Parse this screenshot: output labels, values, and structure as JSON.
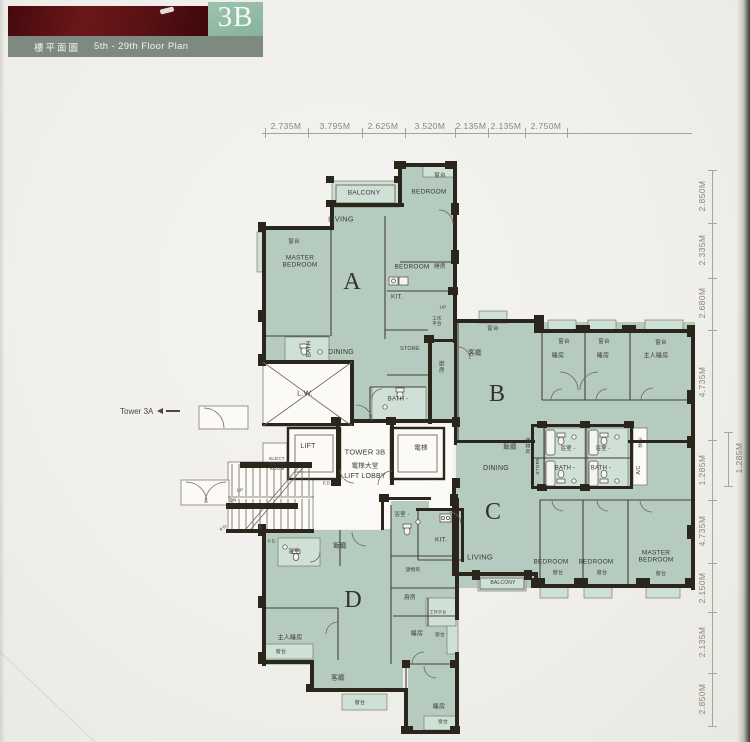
{
  "header": {
    "unit": "3B",
    "title_zh": "樓平面圖",
    "title_en": "5th - 29th Floor Plan"
  },
  "tower_ref": {
    "label": "Tower 3A"
  },
  "plan": {
    "labels": [
      {
        "t": "BALCONY",
        "x": 364,
        "y": 193,
        "s": 6.5
      },
      {
        "t": "窗台",
        "x": 440,
        "y": 176,
        "s": 5.5
      },
      {
        "t": "BEDROOM",
        "x": 429,
        "y": 192,
        "s": 6.5
      },
      {
        "t": "LIVING",
        "x": 341,
        "y": 220,
        "s": 7.5
      },
      {
        "t": "窗台",
        "x": 294,
        "y": 242,
        "s": 5.5
      },
      {
        "t": "MASTER\nBEDROOM",
        "x": 300,
        "y": 262,
        "s": 6.5
      },
      {
        "t": "A",
        "x": 352,
        "y": 283,
        "s": 24
      },
      {
        "t": "BEDROOM",
        "x": 412,
        "y": 267,
        "s": 6.5
      },
      {
        "t": "睡房",
        "x": 440,
        "y": 267,
        "s": 5.5
      },
      {
        "t": "KIT.",
        "x": 397,
        "y": 297,
        "s": 6.5
      },
      {
        "t": "UP",
        "x": 443,
        "y": 307,
        "s": 4.5
      },
      {
        "t": "工作\n平台",
        "x": 437,
        "y": 321,
        "s": 4.5
      },
      {
        "t": "BATH",
        "x": 310,
        "y": 349,
        "s": 6,
        "r": -90
      },
      {
        "t": "DINING",
        "x": 341,
        "y": 353,
        "s": 7
      },
      {
        "t": "STORE",
        "x": 410,
        "y": 349,
        "s": 5.5
      },
      {
        "t": "廚房",
        "x": 440,
        "y": 367,
        "s": 5.5,
        "v": 1
      },
      {
        "t": "BATH -",
        "x": 398,
        "y": 400,
        "s": 6
      },
      {
        "t": "L.W.",
        "x": 305,
        "y": 394,
        "s": 7.5
      },
      {
        "t": "窗台",
        "x": 493,
        "y": 329,
        "s": 5.5
      },
      {
        "t": "客廳",
        "x": 475,
        "y": 353,
        "s": 6.5
      },
      {
        "t": "B",
        "x": 497,
        "y": 395,
        "s": 24
      },
      {
        "t": "窗台",
        "x": 564,
        "y": 342,
        "s": 5.5
      },
      {
        "t": "窗台",
        "x": 604,
        "y": 342,
        "s": 5.5
      },
      {
        "t": "窗台",
        "x": 661,
        "y": 343,
        "s": 5.5
      },
      {
        "t": "睡房",
        "x": 558,
        "y": 357,
        "s": 6
      },
      {
        "t": "睡房",
        "x": 603,
        "y": 357,
        "s": 6
      },
      {
        "t": "主人睡房",
        "x": 656,
        "y": 357,
        "s": 6
      },
      {
        "t": "飯廳",
        "x": 510,
        "y": 447,
        "s": 6.5
      },
      {
        "t": "儲物房",
        "x": 526,
        "y": 446,
        "s": 4.8,
        "v": 1
      },
      {
        "t": "STORE",
        "x": 539,
        "y": 466,
        "s": 4.8,
        "r": -90
      },
      {
        "t": "浴室 -",
        "x": 568,
        "y": 449,
        "s": 5.5
      },
      {
        "t": "浴室 -",
        "x": 603,
        "y": 449,
        "s": 5.5
      },
      {
        "t": "冷氣",
        "x": 640,
        "y": 443,
        "s": 4.5,
        "v": 1
      },
      {
        "t": "A/C",
        "x": 640,
        "y": 470,
        "s": 5,
        "r": -90
      },
      {
        "t": "DINING",
        "x": 496,
        "y": 469,
        "s": 7
      },
      {
        "t": "BATH -",
        "x": 565,
        "y": 469,
        "s": 6
      },
      {
        "t": "BATH -",
        "x": 601,
        "y": 469,
        "s": 6
      },
      {
        "t": "C",
        "x": 493,
        "y": 513,
        "s": 24
      },
      {
        "t": "LIVING",
        "x": 480,
        "y": 558,
        "s": 7.5
      },
      {
        "t": "KIT.",
        "x": 441,
        "y": 540,
        "s": 6.5
      },
      {
        "t": "BEDROOM",
        "x": 551,
        "y": 562,
        "s": 6.5
      },
      {
        "t": "BEDROOM",
        "x": 596,
        "y": 562,
        "s": 6.5
      },
      {
        "t": "MASTER\nBEDROOM",
        "x": 656,
        "y": 557,
        "s": 6.5
      },
      {
        "t": "窗台",
        "x": 558,
        "y": 574,
        "s": 5
      },
      {
        "t": "窗台",
        "x": 602,
        "y": 574,
        "s": 5
      },
      {
        "t": "窗台",
        "x": 661,
        "y": 575,
        "s": 5
      },
      {
        "t": "BALCONY",
        "x": 503,
        "y": 584,
        "s": 5
      },
      {
        "t": "P.D.",
        "x": 327,
        "y": 484,
        "s": 4.2
      },
      {
        "t": "P.D.",
        "x": 224,
        "y": 528,
        "s": 4.2,
        "r": -40
      },
      {
        "t": "P.D.",
        "x": 272,
        "y": 541,
        "s": 4.5
      },
      {
        "t": "浴室",
        "x": 294,
        "y": 552,
        "s": 5.5
      },
      {
        "t": "飯廳",
        "x": 340,
        "y": 546,
        "s": 6.5
      },
      {
        "t": "浴室 -",
        "x": 402,
        "y": 515,
        "s": 5.5
      },
      {
        "t": "D",
        "x": 353,
        "y": 601,
        "s": 24
      },
      {
        "t": "儲物房",
        "x": 413,
        "y": 571,
        "s": 4.8
      },
      {
        "t": "廚房",
        "x": 410,
        "y": 598,
        "s": 5.5
      },
      {
        "t": "工作平台",
        "x": 438,
        "y": 613,
        "s": 4
      },
      {
        "t": "睡房",
        "x": 417,
        "y": 635,
        "s": 6
      },
      {
        "t": "窗台",
        "x": 440,
        "y": 636,
        "s": 4.8
      },
      {
        "t": "主人睡房",
        "x": 290,
        "y": 639,
        "s": 6
      },
      {
        "t": "窗台",
        "x": 281,
        "y": 653,
        "s": 5
      },
      {
        "t": "客廳",
        "x": 338,
        "y": 678,
        "s": 6.5
      },
      {
        "t": "窗台",
        "x": 360,
        "y": 704,
        "s": 5
      },
      {
        "t": "睡房",
        "x": 439,
        "y": 708,
        "s": 6
      },
      {
        "t": "窗台",
        "x": 443,
        "y": 723,
        "s": 4.8
      },
      {
        "t": "UP",
        "x": 240,
        "y": 490,
        "s": 4.5
      },
      {
        "t": "DN",
        "x": 233,
        "y": 500,
        "s": 4.5
      },
      {
        "t": "LIFT",
        "x": 308,
        "y": 447,
        "s": 7
      },
      {
        "t": "電梯",
        "x": 421,
        "y": 448,
        "s": 6.5
      },
      {
        "t": "TOWER 3B",
        "x": 365,
        "y": 453,
        "s": 7.5
      },
      {
        "t": "電梯大堂",
        "x": 365,
        "y": 466,
        "s": 6.5
      },
      {
        "t": "LIFT LOBBY",
        "x": 365,
        "y": 477,
        "s": 7
      },
      {
        "t": "ELECT\nMETER\nROOM",
        "x": 277,
        "y": 464,
        "s": 4.5
      }
    ]
  },
  "dimensions": {
    "top": {
      "y": 133,
      "x1": 262,
      "x2": 692,
      "ticks": [
        265,
        308,
        362,
        405,
        455,
        488,
        525,
        567
      ],
      "labels": [
        {
          "t": "2.735M",
          "x": 286
        },
        {
          "t": "3.795M",
          "x": 335
        },
        {
          "t": "2.625M",
          "x": 383
        },
        {
          "t": "3.520M",
          "x": 430
        },
        {
          "t": "2.135M",
          "x": 471
        },
        {
          "t": "2.135M",
          "x": 506
        },
        {
          "t": "2.750M",
          "x": 546
        }
      ]
    },
    "right": {
      "x": 712,
      "y1": 170,
      "y2": 726,
      "ticks": [
        170,
        223,
        278,
        330,
        440,
        500,
        563,
        612,
        673,
        726
      ],
      "labels": [
        {
          "t": "2.850M",
          "y": 196
        },
        {
          "t": "2.335M",
          "y": 250
        },
        {
          "t": "2.680M",
          "y": 303
        },
        {
          "t": "4.735M",
          "y": 382
        },
        {
          "t": "1.285M",
          "y": 470
        },
        {
          "t": "4.735M",
          "y": 531
        },
        {
          "t": "2.150M",
          "y": 588
        },
        {
          "t": "2.135M",
          "y": 642
        },
        {
          "t": "2.850M",
          "y": 699
        }
      ]
    },
    "right_outer": {
      "x": 728,
      "y1": 432,
      "y2": 486,
      "label": {
        "t": "1.285M",
        "x": 739,
        "y": 458
      }
    }
  },
  "colors": {
    "banner_red": "#591114",
    "badge_green": "#8fb8a2",
    "bar_gray": "#7e8a80",
    "paper": "#f0efeb",
    "unit_fill": "#b5cbc0",
    "unit_fill_light": "#cfe0d6",
    "wall_dark": "#2a261c",
    "white_room": "#fbfaf7",
    "dim_text": "#87857b",
    "label_text": "#3b3a33"
  }
}
